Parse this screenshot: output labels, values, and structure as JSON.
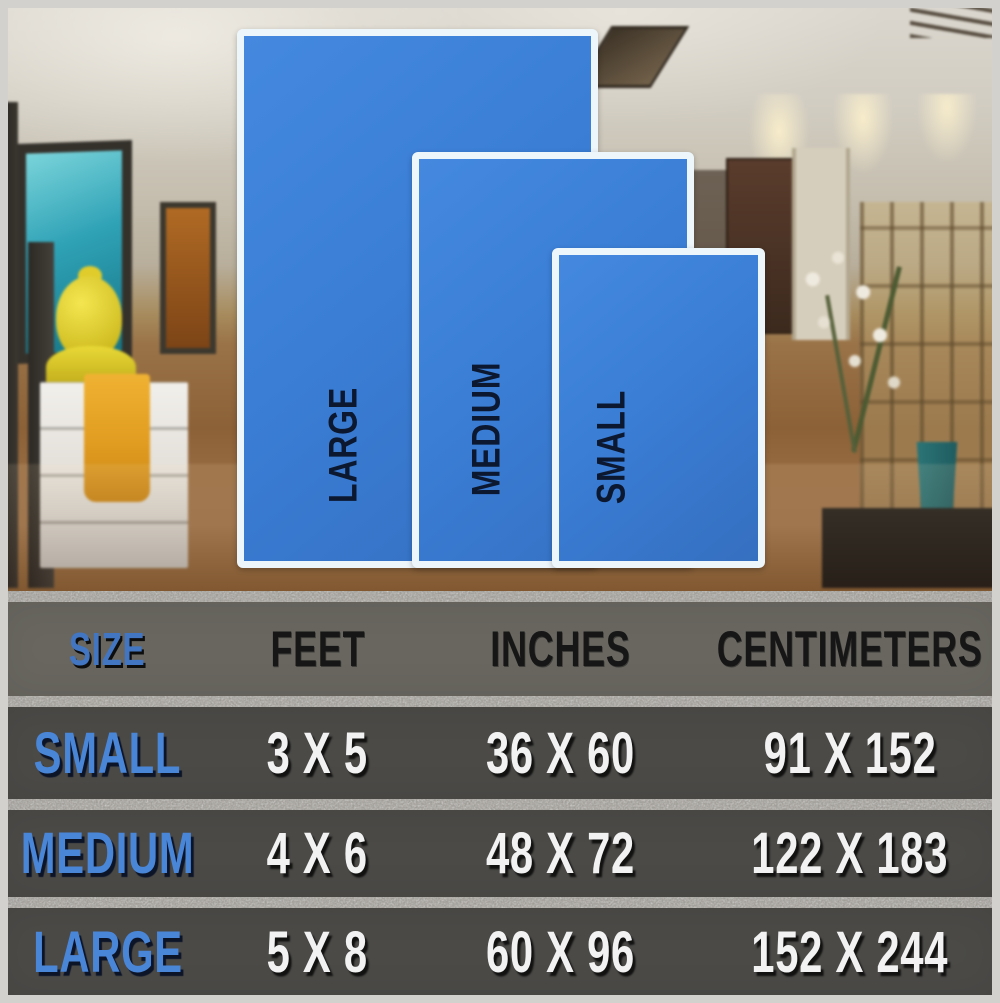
{
  "rug_preview": {
    "labels": {
      "large": "LARGE",
      "medium": "MEDIUM",
      "small": "SMALL"
    },
    "rug_fill_color": "#3a7ed6",
    "rug_border_color": "#edf6fb",
    "rug_label_color": "#0c1830"
  },
  "chart_data": {
    "type": "table",
    "columns": [
      "SIZE",
      "FEET",
      "INCHES",
      "CENTIMETERS"
    ],
    "rows": [
      [
        "SMALL",
        "3 X 5",
        "36 X 60",
        "91 X 152"
      ],
      [
        "MEDIUM",
        "4 X 6",
        "48 X 72",
        "122 X 183"
      ],
      [
        "LARGE",
        "5 X 8",
        "60 X 96",
        "152 X 244"
      ]
    ]
  },
  "colors": {
    "accent_blue": "#4a86d8",
    "header_text": "#161616",
    "value_text": "#f2f2f2",
    "table_header_bg": "#68665f",
    "table_row_bg": "#4b4a47",
    "divider": "#a5a29c"
  }
}
